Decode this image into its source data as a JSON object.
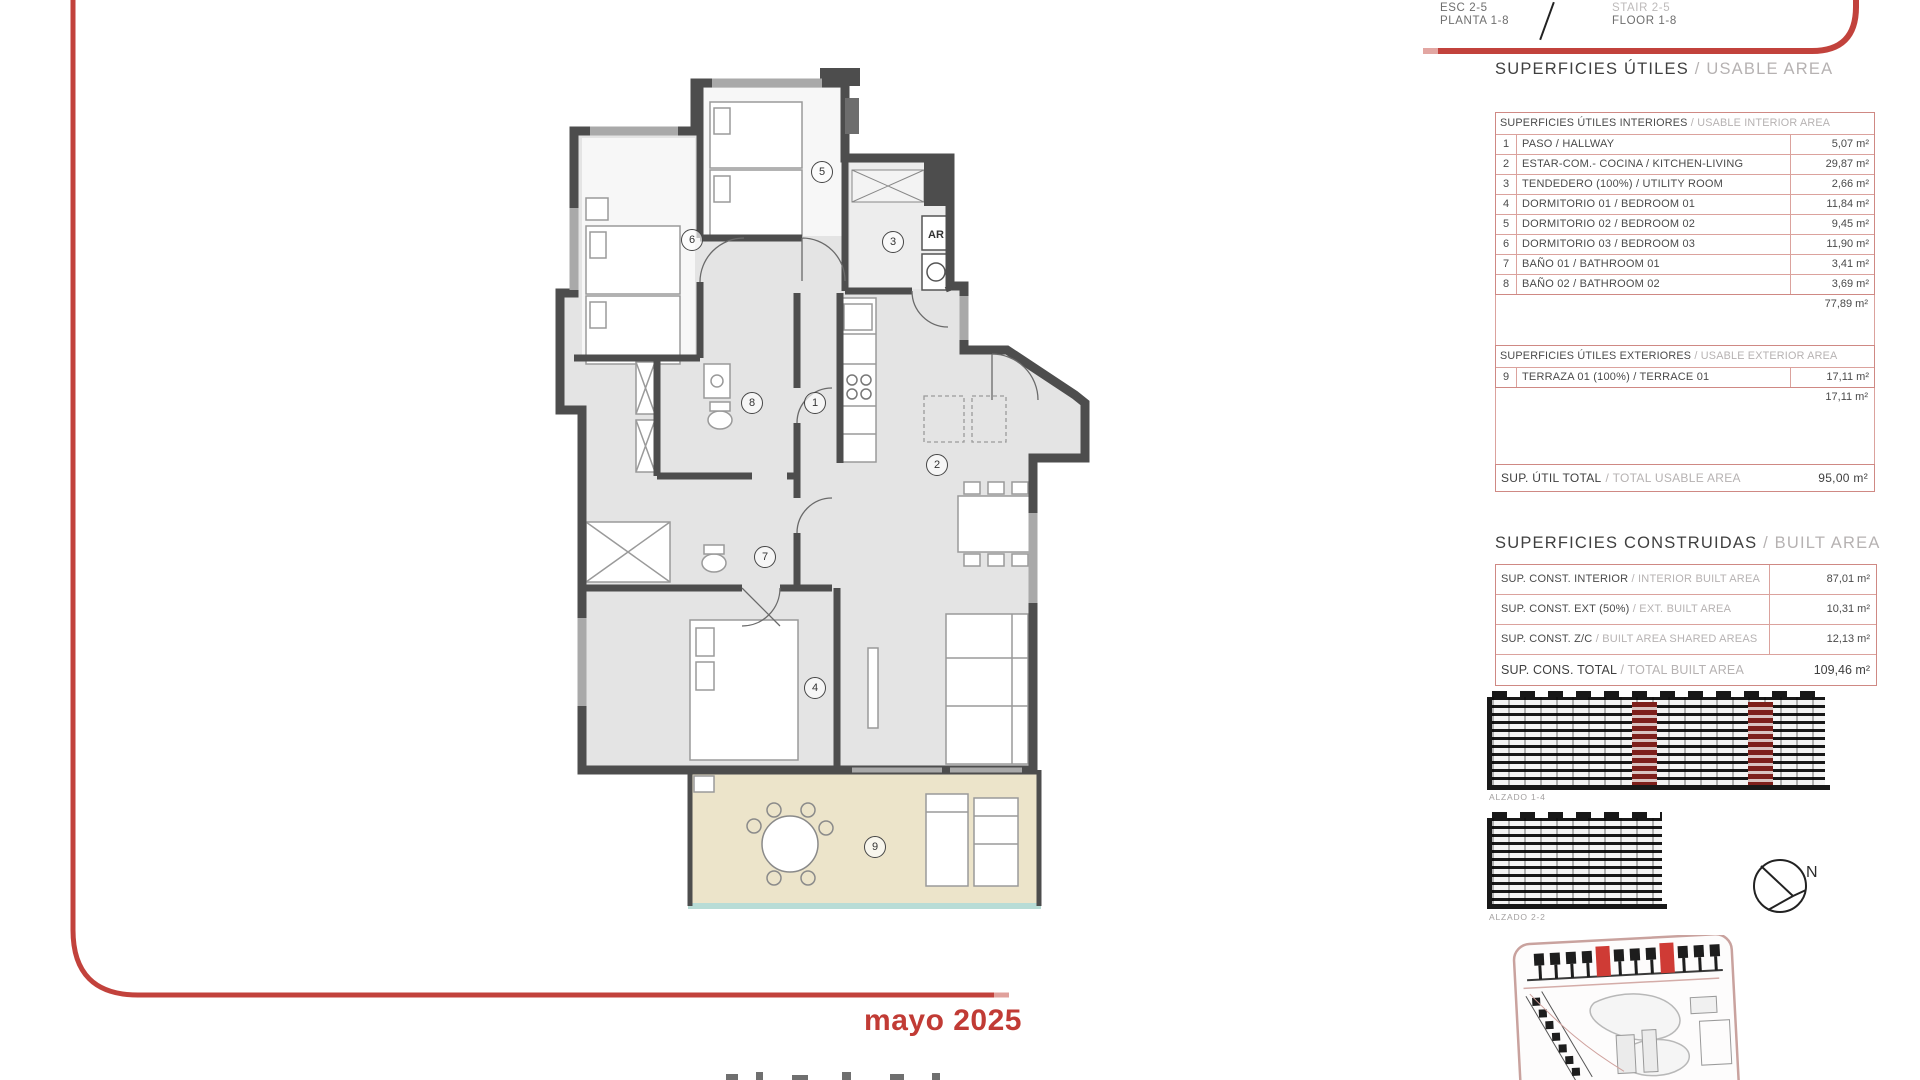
{
  "meta": {
    "date": "mayo 2025"
  },
  "header": {
    "esc": "ESC 2-5",
    "planta": "PLANTA 1-8",
    "stair": "STAIR 2-5",
    "floor": "FLOOR 1-8"
  },
  "usable": {
    "title": "SUPERFICIES ÚTILES",
    "title_en": "/ USABLE AREA",
    "interior_header": "SUPERFICIES ÚTILES INTERIORES",
    "interior_header_en": "/ USABLE INTERIOR AREA",
    "interior_rows": [
      {
        "num": "1",
        "name": "PASO / HALLWAY",
        "value": "5,07 m²"
      },
      {
        "num": "2",
        "name": "ESTAR-COM.- COCINA / KITCHEN-LIVING",
        "value": "29,87 m²"
      },
      {
        "num": "3",
        "name": "TENDEDERO (100%) / UTILITY ROOM",
        "value": "2,66 m²"
      },
      {
        "num": "4",
        "name": "DORMITORIO 01 / BEDROOM 01",
        "value": "11,84 m²"
      },
      {
        "num": "5",
        "name": "DORMITORIO 02 / BEDROOM 02",
        "value": "9,45 m²"
      },
      {
        "num": "6",
        "name": "DORMITORIO 03 / BEDROOM 03",
        "value": "11,90 m²"
      },
      {
        "num": "7",
        "name": "BAÑO 01 / BATHROOM 01",
        "value": "3,41 m²"
      },
      {
        "num": "8",
        "name": "BAÑO 02 / BATHROOM 02",
        "value": "3,69 m²"
      }
    ],
    "interior_subtotal": "77,89 m²",
    "exterior_header": "SUPERFICIES ÚTILES EXTERIORES",
    "exterior_header_en": "/ USABLE EXTERIOR AREA",
    "exterior_rows": [
      {
        "num": "9",
        "name": "TERRAZA 01 (100%) / TERRACE 01",
        "value": "17,11 m²"
      }
    ],
    "exterior_subtotal": "17,11 m²",
    "total_label": "SUP. ÚTIL TOTAL",
    "total_label_en": "/ TOTAL USABLE AREA",
    "total_value": "95,00 m²"
  },
  "built": {
    "title": "SUPERFICIES CONSTRUIDAS",
    "title_en": "/ BUILT AREA",
    "rows": [
      {
        "label": "SUP. CONST. INTERIOR",
        "label_en": "/ INTERIOR BUILT AREA",
        "value": "87,01 m²"
      },
      {
        "label": "SUP. CONST. EXT (50%)",
        "label_en": "/ EXT. BUILT AREA",
        "value": "10,31 m²"
      },
      {
        "label": "SUP. CONST. Z/C",
        "label_en": "/ BUILT AREA SHARED AREAS",
        "value": "12,13 m²"
      }
    ],
    "total_label": "SUP. CONS. TOTAL",
    "total_label_en": "/ TOTAL BUILT AREA",
    "total_value": "109,46 m²"
  },
  "plan": {
    "rooms": [
      "1",
      "2",
      "3",
      "4",
      "5",
      "6",
      "7",
      "8",
      "9"
    ],
    "appliance_label": "AR"
  },
  "drawings": {
    "elevation1_label": "ALZADO 1-4",
    "elevation2_label": "ALZADO 2-2",
    "north_label": "N"
  },
  "colors": {
    "accent_red": "#c2423c",
    "table_border": "#cf8984",
    "dark_text": "#3f3f3f",
    "muted_text": "#b6b2b2",
    "wall": "#4d4d4d",
    "floor": "#e4e4e4",
    "terrace": "#ece4ca",
    "balustrade": "#b8dcd6",
    "elevation_highlight": "#7d1f1b",
    "siteplan_highlight": "#cf3b35"
  }
}
